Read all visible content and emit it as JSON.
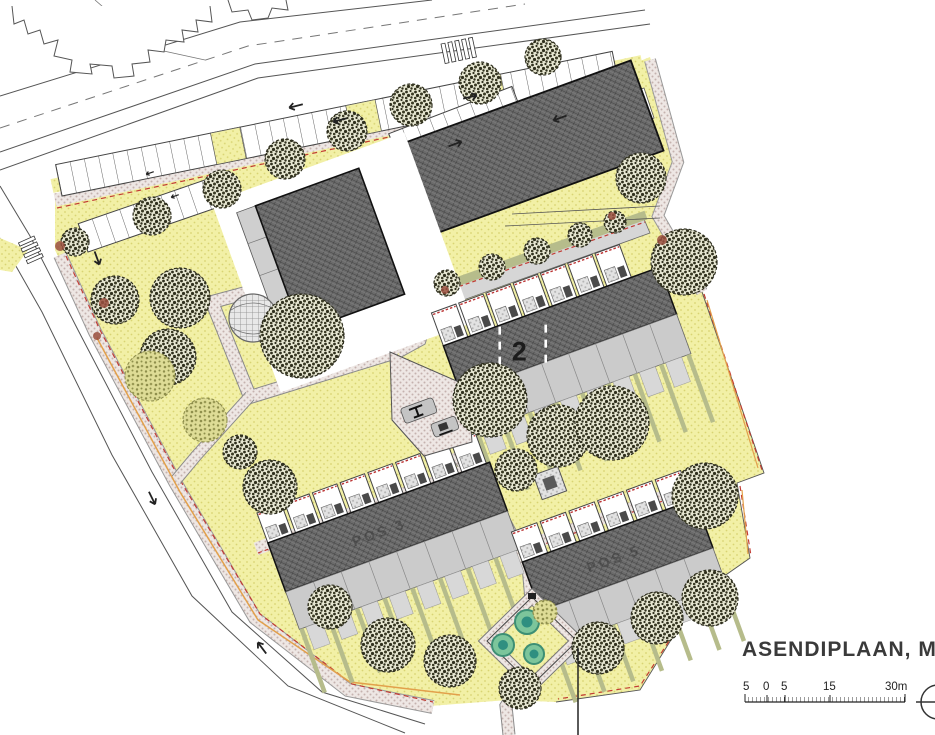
{
  "drawing": {
    "title": "ASENDIPLAAN, M1:",
    "labels": {
      "block2": "2",
      "pos3": "POS 3",
      "pos5": "POS 5"
    },
    "scale_bar": {
      "labels": [
        "5",
        "0",
        "5",
        "15",
        "30m"
      ]
    },
    "colors": {
      "grass": "#f2f0a6",
      "building_roof": "#6b6b6b",
      "terrace": "#cbcbcb",
      "hedge": "#b6bc8b",
      "paving": "#eee7e4",
      "boundary_red": "#c23b33",
      "path_orange": "#e2a04b",
      "play_teal": "#2f8f80"
    }
  }
}
